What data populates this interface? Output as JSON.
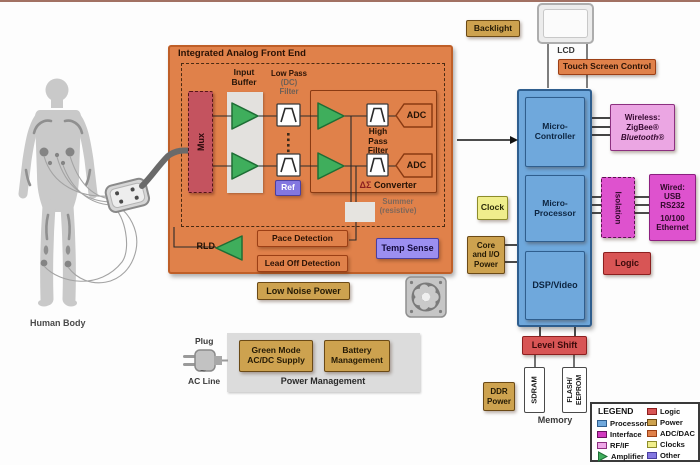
{
  "afe": {
    "title": "Integrated Analog Front End",
    "mux": "Mux",
    "input_buffer": [
      "Input",
      "Buffer"
    ],
    "low_pass": [
      "Low Pass",
      "(DC)",
      "Filter"
    ],
    "ref": "Ref",
    "high_pass": [
      "High",
      "Pass",
      "Filter"
    ],
    "adc": "ADC",
    "converter_sym": "ΔΣ",
    "converter": "Converter",
    "summer": [
      "Summer",
      "(resistive)"
    ],
    "rld": "RLD",
    "pace": "Pace Detection",
    "lead_off": "Lead Off Detection",
    "temp_sense": "Temp Sense",
    "low_noise": "Low Noise Power"
  },
  "body": {
    "label": "Human Body"
  },
  "display": {
    "backlight": "Backlight",
    "lcd": "LCD",
    "touch": "Touch Screen Control"
  },
  "system": {
    "micro_controller": [
      "Micro-",
      "Controller"
    ],
    "micro_processor": [
      "Micro-",
      "Processor"
    ],
    "dsp": "DSP/Video",
    "logic": "Logic",
    "clock": "Clock",
    "level_shift": "Level Shift"
  },
  "comm": {
    "wireless": [
      "Wireless:",
      "ZigBee®",
      "Bluetooth®"
    ],
    "isolation": "Isolation",
    "wired": [
      "Wired:",
      "USB",
      "RS232",
      "10/100",
      "Ethernet"
    ]
  },
  "power": {
    "core_io": [
      "Core",
      "and I/O",
      "Power"
    ],
    "ddr": [
      "DDR",
      "Power"
    ],
    "plug": "Plug",
    "ac_symbol": "~",
    "ac_line": "AC Line",
    "green_mode": [
      "Green Mode",
      "AC/DC Supply"
    ],
    "battery": [
      "Battery",
      "Management"
    ],
    "label": "Power Management"
  },
  "memory": {
    "sdram": "SDRAM",
    "flash": [
      "FLASH/",
      "EEPROM"
    ],
    "label": "Memory"
  },
  "legend": {
    "title": "LEGEND",
    "col1": [
      {
        "label": "Processor",
        "color": "#6FA8DC",
        "border": "#2F5E8E"
      },
      {
        "label": "Interface",
        "color": "#D13ABF",
        "border": "#6B1060"
      },
      {
        "label": "RF/IF",
        "color": "#EFA8E8",
        "border": "#8C3080"
      },
      {
        "label": "Amplifier",
        "color": "#3FAE5C",
        "border": "#1E6E35",
        "shape": "triangle"
      }
    ],
    "col2": [
      {
        "label": "Logic",
        "color": "#D85555",
        "border": "#8C1F1F"
      },
      {
        "label": "Power",
        "color": "#CDA24F",
        "border": "#6B4A16"
      },
      {
        "label": "ADC/DAC",
        "color": "#E0814A",
        "border": "#9C3F15"
      },
      {
        "label": "Clocks",
        "color": "#F0EE8C",
        "border": "#8C8C2A"
      },
      {
        "label": "Other",
        "color": "#8377E0",
        "border": "#4A3FA0"
      }
    ]
  }
}
